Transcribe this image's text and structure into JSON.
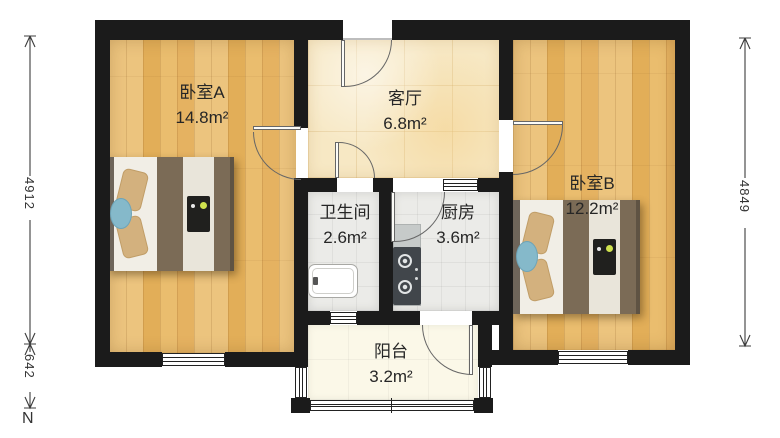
{
  "floorplan": {
    "rooms": {
      "bedroom_a": {
        "name": "卧室A",
        "area": "14.8m²"
      },
      "living_room": {
        "name": "客厅",
        "area": "6.8m²"
      },
      "bedroom_b": {
        "name": "卧室B",
        "area": "12.2m²"
      },
      "bathroom": {
        "name": "卫生间",
        "area": "2.6m²"
      },
      "kitchen": {
        "name": "厨房",
        "area": "3.6m²"
      },
      "balcony": {
        "name": "阳台",
        "area": "3.2m²"
      }
    },
    "dimensions": {
      "left_upper": "4912",
      "left_lower": "642",
      "right": "4849",
      "north": "N"
    },
    "colors": {
      "wall": "#1b1b1b",
      "wood_floor": "#e8bb70",
      "living_tile": "#f7e8c4",
      "wet_tile": "#ebebe8",
      "balcony_floor": "#fbf8e8",
      "dimension_line": "#3c3c3c"
    }
  }
}
